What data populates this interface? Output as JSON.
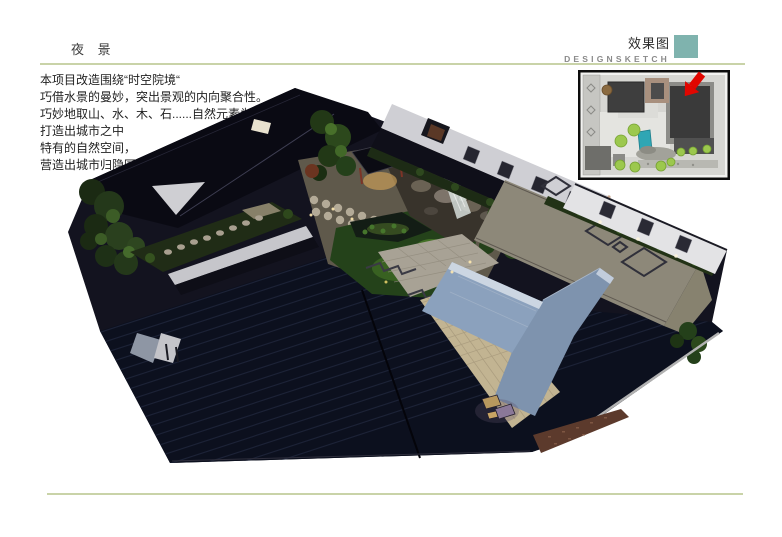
{
  "page": {
    "title": "夜 景"
  },
  "header": {
    "right_title": "效果图",
    "right_subtitle": "DESIGNSKETCH"
  },
  "description": {
    "lines": [
      "本项目改造围绕“时空院境“",
      "巧借水景的曼妙，突出景观的内向聚合性。",
      "巧妙地取山、水、木、石......自然元素为小品，",
      "打造出城市之中",
      "特有的自然空间，",
      "营造出城市归隐园林的梦境氛围。"
    ]
  },
  "colors": {
    "accent_teal": "#7fb3ae",
    "rule_olive": "#c9d3a8",
    "arrow_red": "#e10600",
    "title_text": "#3d3d3d",
    "right_title_text": "#2b2b2b",
    "subtitle_text": "#8a8a8a",
    "body_text": "#222222"
  }
}
